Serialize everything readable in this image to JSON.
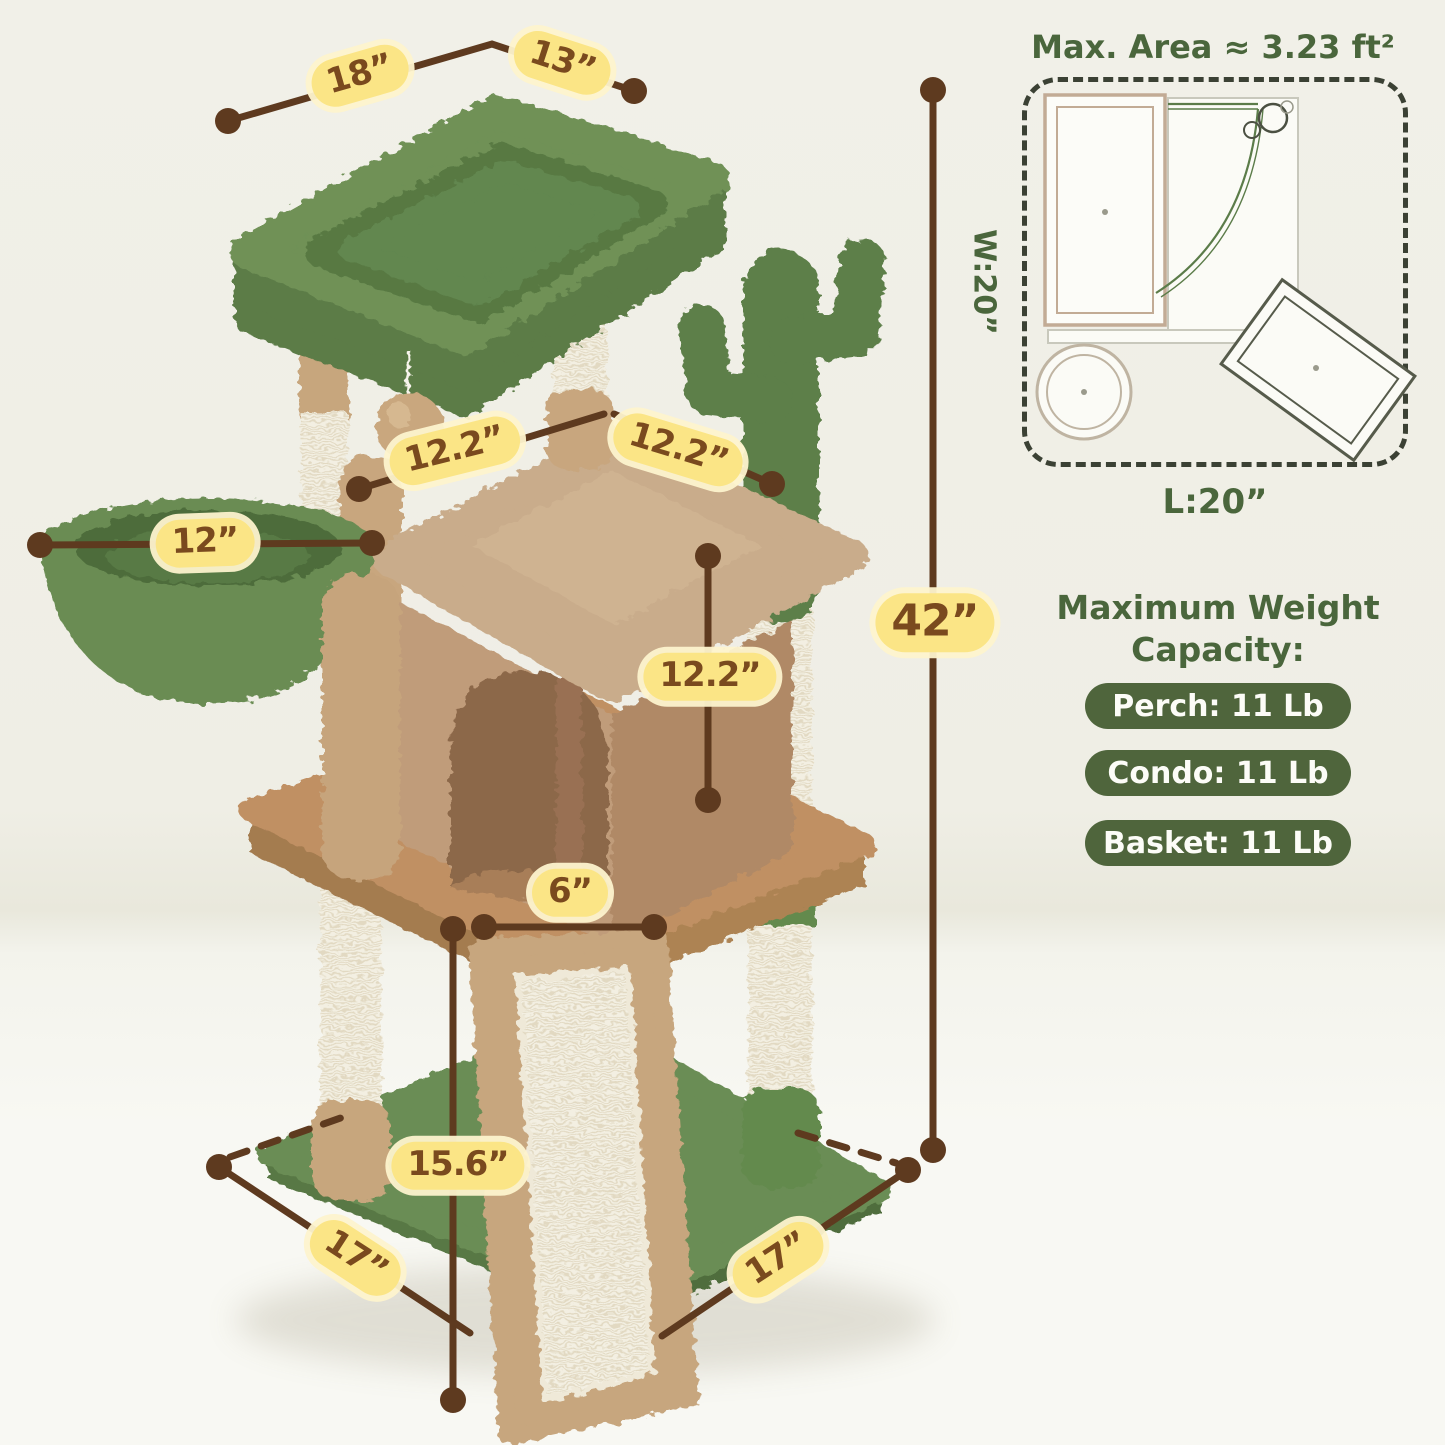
{
  "product_diagram": {
    "dim_labels": {
      "perch_length": "18”",
      "perch_width": "13”",
      "basket_diameter": "12”",
      "condo_top_left": "12.2”",
      "condo_top_right": "12.2”",
      "condo_height": "12.2”",
      "total_height": "42”",
      "ramp_top_width": "6”",
      "ramp_length": "15.6”",
      "base_length": "17”",
      "base_width": "17”"
    },
    "footprint_panel": {
      "title": "Max. Area ≈ 3.23 ft²",
      "width_label": "W:20”",
      "length_label": "L:20”"
    },
    "weight_panel": {
      "title_line1": "Maximum Weight",
      "title_line2": "Capacity:",
      "items": [
        {
          "label": "Perch: 11 Lb"
        },
        {
          "label": "Condo: 11 Lb"
        },
        {
          "label": "Basket: 11 Lb"
        }
      ]
    },
    "colors": {
      "background_wall": "#f0efe6",
      "background_floor": "#f8f8f3",
      "label_pill_yellow": "#fbe586",
      "label_text_brown": "#7a4a1e",
      "dimension_line_brown": "#5e3a1f",
      "heading_green": "#4a663c",
      "capacity_pill_green": "#4f653c",
      "perch_green": "#6f9157",
      "cactus_green": "#5d7f4a",
      "plush_beige": "#c7a67d",
      "condo_beige": "#c09c7a",
      "sisal_cream": "#f3efe2"
    }
  }
}
